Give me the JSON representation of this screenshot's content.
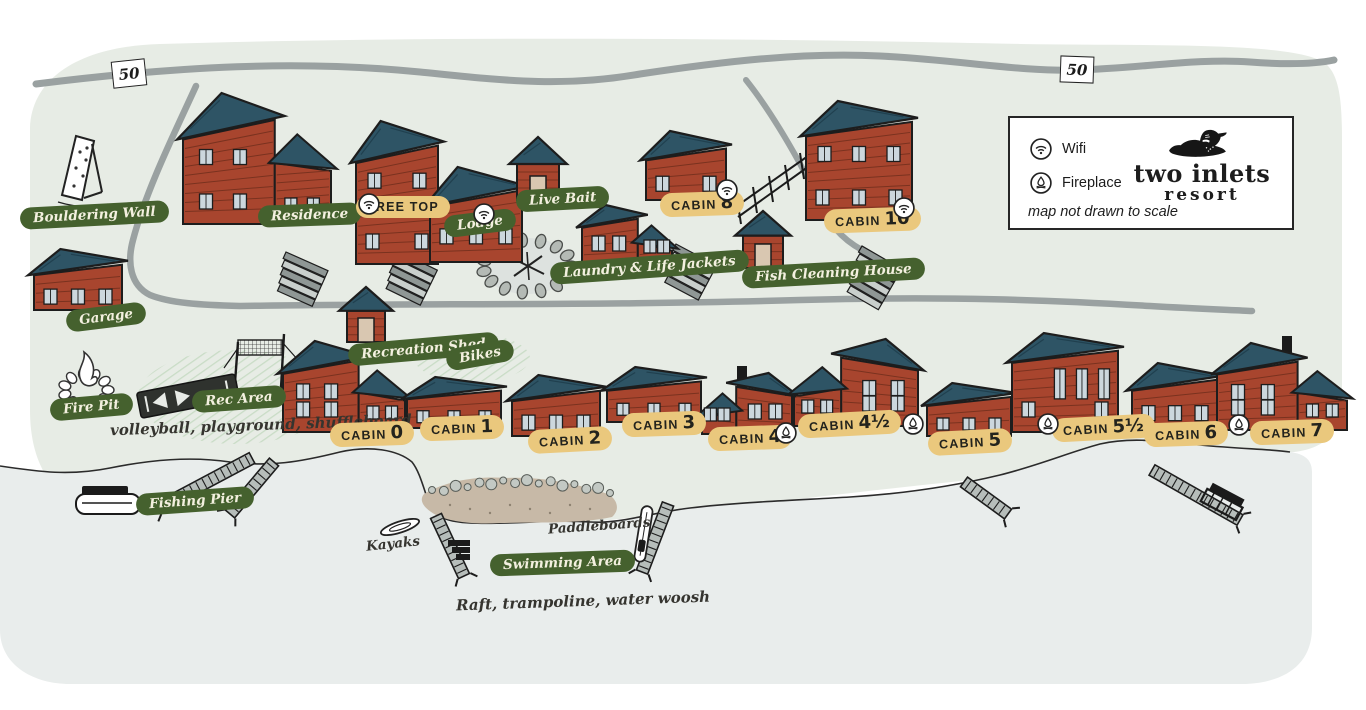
{
  "map": {
    "disclaimer": "map not drawn to scale",
    "brand": {
      "line1": "two inlets",
      "line2": "resort"
    },
    "legend": [
      {
        "icon": "wifi",
        "label": "Wifi"
      },
      {
        "icon": "fireplace",
        "label": "Fireplace"
      }
    ],
    "highway_shields": [
      {
        "label": "50"
      },
      {
        "label": "50"
      }
    ]
  },
  "amenities": [
    {
      "id": "bouldering-wall",
      "label": "Bouldering Wall"
    },
    {
      "id": "residence",
      "label": "Residence"
    },
    {
      "id": "lodge",
      "label": "Lodge",
      "wifi": true
    },
    {
      "id": "live-bait",
      "label": "Live Bait"
    },
    {
      "id": "laundry",
      "label": "Laundry & Life Jackets"
    },
    {
      "id": "fish-cleaning-house",
      "label": "Fish Cleaning House"
    },
    {
      "id": "garage",
      "label": "Garage"
    },
    {
      "id": "recreation-shed",
      "label": "Recreation Shed"
    },
    {
      "id": "bikes",
      "label": "Bikes"
    },
    {
      "id": "fire-pit",
      "label": "Fire Pit"
    },
    {
      "id": "rec-area",
      "label": "Rec Area"
    },
    {
      "id": "fishing-pier",
      "label": "Fishing Pier"
    },
    {
      "id": "swimming-area",
      "label": "Swimming Area"
    }
  ],
  "units": [
    {
      "id": "tree-top",
      "label": "TREE TOP",
      "wifi": true
    },
    {
      "id": "cabin-8",
      "label": "CABIN",
      "number": "8",
      "wifi": true
    },
    {
      "id": "cabin-10",
      "label": "CABIN",
      "number": "10",
      "wifi": true
    },
    {
      "id": "cabin-0",
      "label": "CABIN",
      "number": "0"
    },
    {
      "id": "cabin-1",
      "label": "CABIN",
      "number": "1"
    },
    {
      "id": "cabin-2",
      "label": "CABIN",
      "number": "2"
    },
    {
      "id": "cabin-3",
      "label": "CABIN",
      "number": "3"
    },
    {
      "id": "cabin-4",
      "label": "CABIN",
      "number": "4",
      "fireplace": true
    },
    {
      "id": "cabin-4half",
      "label": "CABIN",
      "number": "4½",
      "fireplace": true
    },
    {
      "id": "cabin-5",
      "label": "CABIN",
      "number": "5"
    },
    {
      "id": "cabin-5half",
      "label": "CABIN",
      "number": "5½",
      "fireplace": true
    },
    {
      "id": "cabin-6",
      "label": "CABIN",
      "number": "6"
    },
    {
      "id": "cabin-7",
      "label": "CABIN",
      "number": "7",
      "fireplace": true
    }
  ],
  "annotations": {
    "rec_area_note": "volleyball, playground, shuffleboard",
    "swimming_note": "Raft, trampoline, water woosh",
    "kayaks": "Kayaks",
    "paddleboards": "Paddleboards"
  },
  "colors": {
    "land": "#e7ece5",
    "water": "#e9edec",
    "road": "#9aa1a1",
    "label_green": "#45612e",
    "label_yellow": "#eac87d",
    "cabin_red": "#a8452e",
    "roof_teal": "#2e5465"
  }
}
